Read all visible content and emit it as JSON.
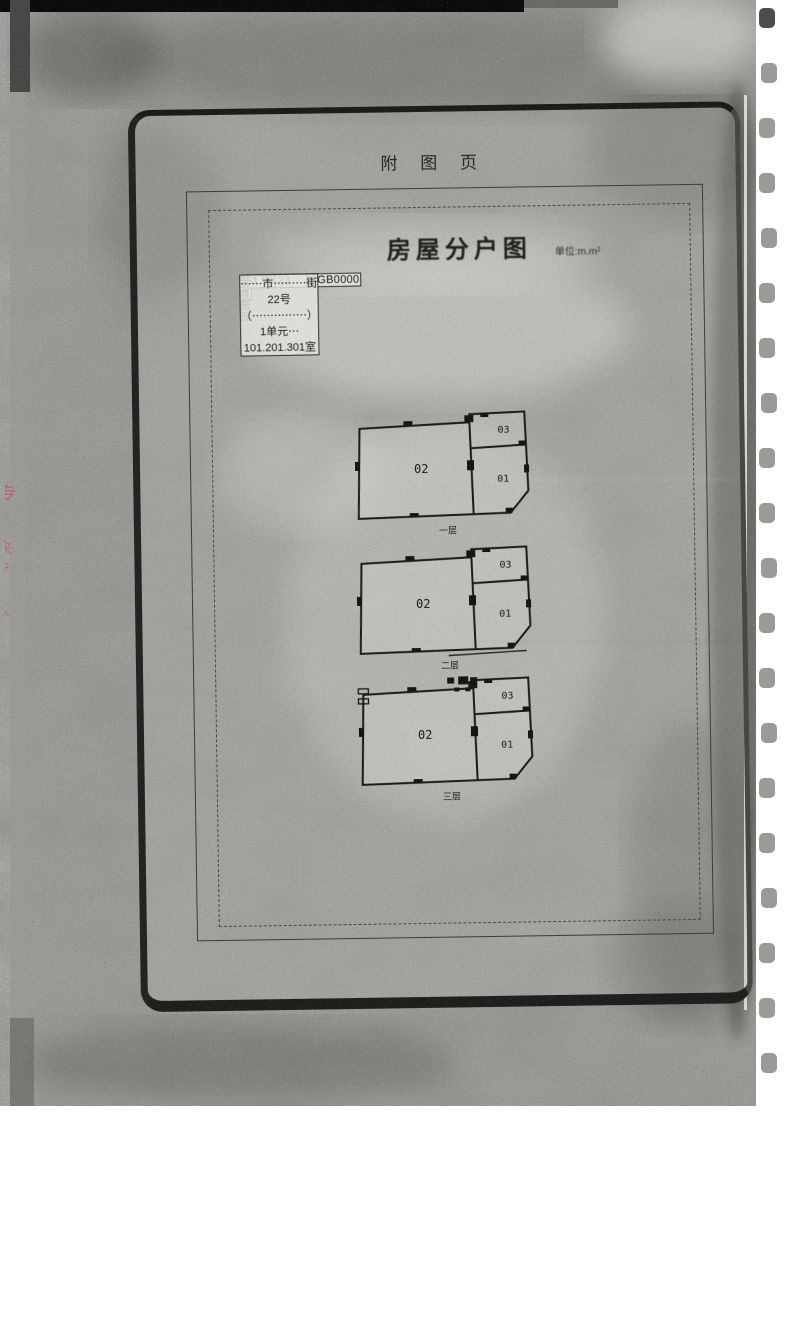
{
  "scan": {
    "header_title": "附 图 页",
    "doc_title": "房屋分户图",
    "unit_note": "单位:m.m²"
  },
  "table": {
    "rows": [
      {
        "c1": "丘号",
        "c2": "210882009028GB00001",
        "c3": "结构",
        "c4": "砖混",
        "c5": "套内建筑面积",
        "c6": "531.23"
      },
      {
        "c1": "幢号",
        "c2": "F0001",
        "c3": "总层数",
        "c4": "6",
        "c5": "分摊建筑面积",
        "c6": "20.30"
      },
      {
        "c1": "户号",
        "c2": "0001",
        "c3": "所在层次",
        "c4": "1-3",
        "c5": "建筑面积",
        "c6": "551.53"
      }
    ],
    "address_label": "坐落",
    "address": "⋯⋯市⋯⋯⋯街22号（⋯⋯⋯⋯⋯）1单元⋯101.201.301室"
  },
  "plans": [
    {
      "caption": "一层",
      "room_left": "02",
      "room_top_right": "03",
      "room_right": "01"
    },
    {
      "caption": "二层",
      "room_left": "02",
      "room_top_right": "03",
      "room_right": "01"
    },
    {
      "caption": "三层",
      "room_left": "02",
      "room_top_right": "03",
      "room_right": "01"
    }
  ],
  "stamp_fragments": {
    "f1": "专",
    "f2": "来",
    "f3": "乡",
    "f4": "人"
  },
  "colors": {
    "stamp_red": "#d4566b",
    "ink": "#1c1c1a",
    "paper_noise": "#cbc9c5",
    "hole": "#8f8f8c"
  }
}
